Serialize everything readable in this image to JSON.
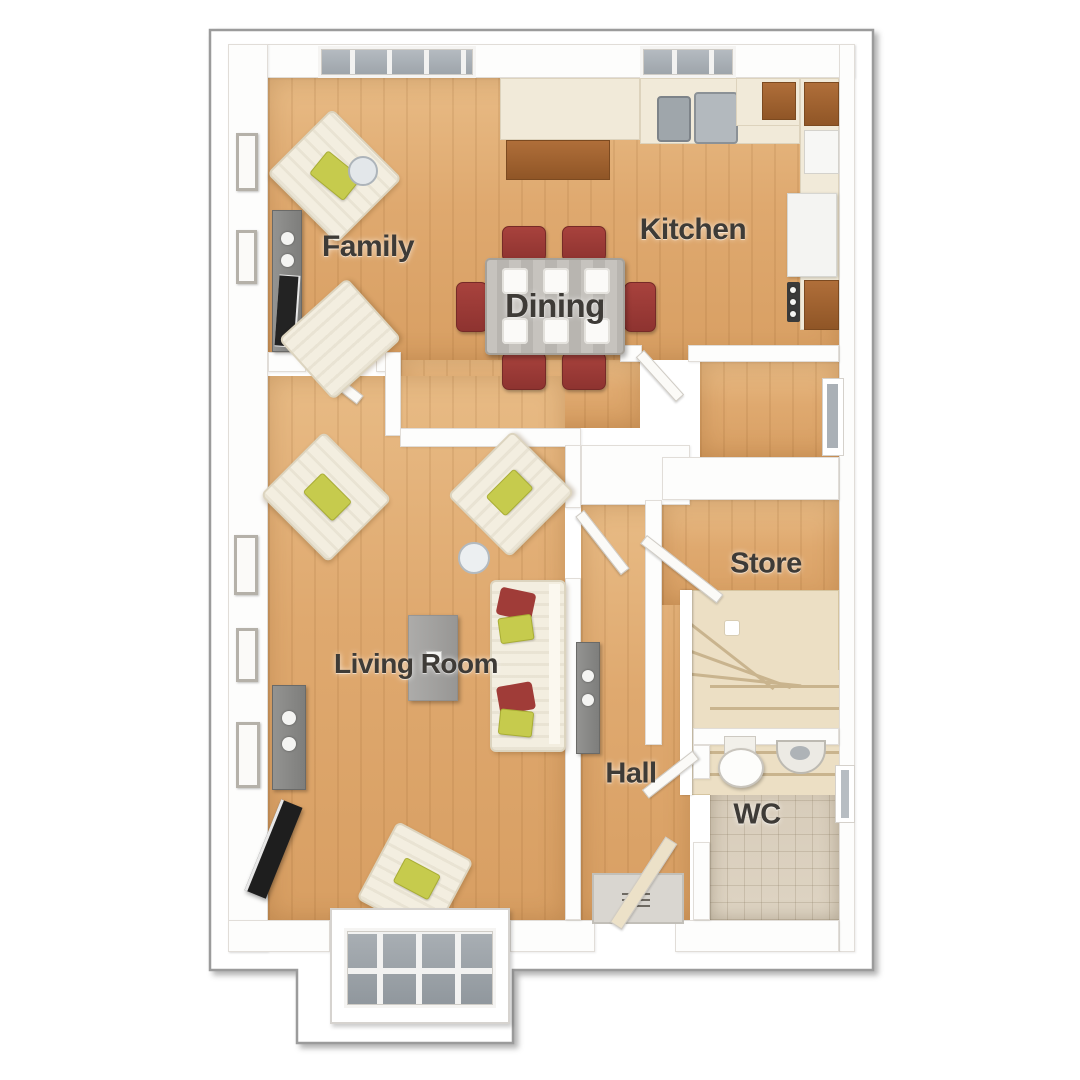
{
  "rooms": {
    "family": {
      "label": "Family"
    },
    "kitchen": {
      "label": "Kitchen"
    },
    "dining": {
      "label": "Dining"
    },
    "living_room": {
      "label": "Living Room"
    },
    "store": {
      "label": "Store"
    },
    "hall": {
      "label": "Hall"
    },
    "wc": {
      "label": "WC"
    }
  },
  "palette": {
    "outline_gray": "#9b9b9b",
    "wall_white": "#fdfdfc",
    "floor_wood": "#dfa96f",
    "tile_beige": "#d8cdbb",
    "stairs_cream": "#ecdfc4",
    "dining_chair_red": "#9c3a35",
    "cushion_yellow": "#c6cb4d",
    "kitchen_cabinet_brown": "#a86a38",
    "glass_gray": "#a7adb3"
  }
}
